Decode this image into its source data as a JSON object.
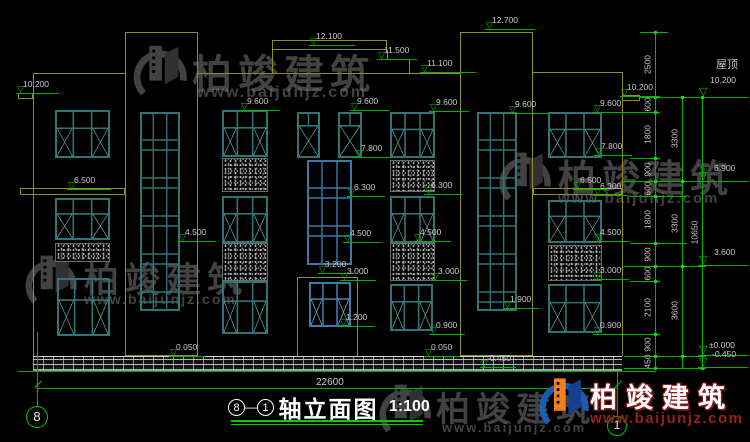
{
  "drawing": {
    "title": {
      "axis_from": "8",
      "axis_to": "1",
      "dash": "—",
      "name": "轴立面图",
      "scale": "1:100"
    },
    "axis_bubbles": {
      "left": "8",
      "right": "1"
    },
    "bottom_total": "22600",
    "roof_label": "屋顶",
    "watermark": {
      "brand": "柏竣建筑",
      "url": "www.baijunjz.com"
    },
    "colors": {
      "outline": "#8f8f28",
      "window_teal": "#2f7575",
      "window_teal_light": "#65a5a5",
      "window_blue": "#3c7aa8",
      "window_blue_light": "#7fb0d4",
      "dim_green": "#00b400",
      "label_text": "#c9c9c9",
      "wm_gray": "#787878",
      "wm_blue": "#1a5cae",
      "wm_orange": "#ee7f22",
      "wm_red": "#9b1f1f"
    },
    "elevation_markers": [
      {
        "t": "10.200",
        "x": 23,
        "y": 80,
        "lw": 42
      },
      {
        "t": "12.100",
        "x": 316,
        "y": 32,
        "lw": 46
      },
      {
        "t": "11.500",
        "x": 384,
        "y": 46,
        "lw": 40
      },
      {
        "t": "11.100",
        "x": 427,
        "y": 59,
        "lw": 56
      },
      {
        "t": "12.700",
        "x": 492,
        "y": 16,
        "lw": 50
      },
      {
        "t": "10.200",
        "x": 627,
        "y": 83,
        "lw": 40
      },
      {
        "t": "9.600",
        "x": 247,
        "y": 97,
        "lw": 40
      },
      {
        "t": "9.600",
        "x": 357,
        "y": 97,
        "lw": 40
      },
      {
        "t": "9.600",
        "x": 436,
        "y": 98,
        "lw": 40
      },
      {
        "t": "9.600",
        "x": 515,
        "y": 100,
        "lw": 40
      },
      {
        "t": "9.600",
        "x": 600,
        "y": 99,
        "lw": 40
      },
      {
        "t": "7.800",
        "x": 361,
        "y": 144,
        "lw": 38
      },
      {
        "t": "7.800",
        "x": 601,
        "y": 142,
        "lw": 38
      },
      {
        "t": "6.500",
        "x": 74,
        "y": 176,
        "lw": 44
      },
      {
        "t": "6.500",
        "x": 580,
        "y": 176,
        "lw": 34
      },
      {
        "t": "6.300",
        "x": 354,
        "y": 183,
        "lw": 38
      },
      {
        "t": "6.300",
        "x": 431,
        "y": 181,
        "lw": 38
      },
      {
        "t": "6.300",
        "x": 600,
        "y": 182,
        "lw": 34
      },
      {
        "t": "4.500",
        "x": 185,
        "y": 228,
        "lw": 38
      },
      {
        "t": "4.500",
        "x": 350,
        "y": 229,
        "lw": 38
      },
      {
        "t": "4.500",
        "x": 420,
        "y": 228,
        "lw": 38
      },
      {
        "t": "4.500",
        "x": 600,
        "y": 228,
        "lw": 36
      },
      {
        "t": "3.200",
        "x": 325,
        "y": 260,
        "lw": 36
      },
      {
        "t": "3.000",
        "x": 347,
        "y": 267,
        "lw": 36
      },
      {
        "t": "3.000",
        "x": 438,
        "y": 267,
        "lw": 36
      },
      {
        "t": "3.000",
        "x": 600,
        "y": 266,
        "lw": 36
      },
      {
        "t": "1.900",
        "x": 510,
        "y": 295,
        "lw": 36
      },
      {
        "t": "1.200",
        "x": 346,
        "y": 313,
        "lw": 36
      },
      {
        "t": "0.900",
        "x": 436,
        "y": 321,
        "lw": 36
      },
      {
        "t": "0.900",
        "x": 600,
        "y": 321,
        "lw": 36
      },
      {
        "t": "0.050",
        "x": 176,
        "y": 343,
        "lw": 36
      },
      {
        "t": "0.050",
        "x": 431,
        "y": 343,
        "lw": 36
      },
      {
        "t": "-0.450",
        "x": 487,
        "y": 354,
        "lw": 36
      }
    ],
    "right_markers": [
      {
        "t": "10.200",
        "x": 710,
        "y": 76,
        "ly": 97,
        "roof": true
      },
      {
        "t": "6.900",
        "x": 714,
        "y": 164,
        "ly": 181
      },
      {
        "t": "3.600",
        "x": 714,
        "y": 248,
        "ly": 265
      },
      {
        "t": "±0.000",
        "x": 709,
        "y": 341,
        "ly": 355
      },
      {
        "t": "-0.450",
        "x": 712,
        "y": 350,
        "ly": 367
      }
    ],
    "dim_chains": [
      {
        "x": 655,
        "top": 32,
        "bottom": 368,
        "segments": [
          {
            "from": 32,
            "to": 97,
            "label": "2500"
          },
          {
            "from": 97,
            "to": 112,
            "label": "600"
          },
          {
            "from": 112,
            "to": 158,
            "label": "1800"
          },
          {
            "from": 158,
            "to": 181,
            "label": "900"
          },
          {
            "from": 181,
            "to": 196,
            "label": "600"
          },
          {
            "from": 196,
            "to": 243,
            "label": "1800"
          },
          {
            "from": 243,
            "to": 266,
            "label": "900"
          },
          {
            "from": 266,
            "to": 281,
            "label": "600"
          },
          {
            "from": 281,
            "to": 334,
            "label": "2100"
          },
          {
            "from": 334,
            "to": 356,
            "label": "900"
          },
          {
            "from": 356,
            "to": 368,
            "label": "450"
          }
        ]
      },
      {
        "x": 682,
        "top": 97,
        "bottom": 368,
        "segments": [
          {
            "from": 97,
            "to": 181,
            "label": "3300"
          },
          {
            "from": 181,
            "to": 266,
            "label": "3300"
          },
          {
            "from": 266,
            "to": 356,
            "label": "3600"
          }
        ]
      },
      {
        "x": 702,
        "top": 97,
        "bottom": 368,
        "segments": [
          {
            "from": 97,
            "to": 368,
            "label": "10650"
          }
        ]
      }
    ],
    "ext_lines": [
      {
        "y": 32,
        "x1": 640,
        "x2": 668
      },
      {
        "y": 97,
        "x1": 640,
        "x2": 706
      },
      {
        "y": 112,
        "x1": 630,
        "x2": 660
      },
      {
        "y": 158,
        "x1": 630,
        "x2": 660
      },
      {
        "y": 181,
        "x1": 624,
        "x2": 706
      },
      {
        "y": 196,
        "x1": 630,
        "x2": 687
      },
      {
        "y": 243,
        "x1": 630,
        "x2": 687
      },
      {
        "y": 266,
        "x1": 624,
        "x2": 706
      },
      {
        "y": 281,
        "x1": 630,
        "x2": 660
      },
      {
        "y": 334,
        "x1": 630,
        "x2": 660
      },
      {
        "y": 356,
        "x1": 624,
        "x2": 706
      },
      {
        "y": 368,
        "x1": 624,
        "x2": 706
      }
    ],
    "facade": {
      "outline": [
        {
          "k": "h",
          "x": 33,
          "y": 73,
          "l": 92
        },
        {
          "k": "v",
          "x": 33,
          "y": 73,
          "l": 283
        },
        {
          "k": "r",
          "x": 18,
          "y": 93,
          "w": 15,
          "h": 6
        },
        {
          "k": "r",
          "x": 125,
          "y": 32,
          "w": 73,
          "h": 324
        },
        {
          "k": "h",
          "x": 198,
          "y": 73,
          "l": 262
        },
        {
          "k": "r",
          "x": 272,
          "y": 40,
          "w": 115,
          "h": 10
        },
        {
          "k": "v",
          "x": 272,
          "y": 50,
          "l": 23
        },
        {
          "k": "v",
          "x": 387,
          "y": 50,
          "l": 9
        },
        {
          "k": "h",
          "x": 387,
          "y": 59,
          "l": 22
        },
        {
          "k": "v",
          "x": 409,
          "y": 59,
          "l": 14
        },
        {
          "k": "r",
          "x": 460,
          "y": 32,
          "w": 73,
          "h": 324
        },
        {
          "k": "h",
          "x": 533,
          "y": 72,
          "l": 89
        },
        {
          "k": "v",
          "x": 622,
          "y": 72,
          "l": 284
        },
        {
          "k": "r",
          "x": 622,
          "y": 95,
          "w": 18,
          "h": 6
        },
        {
          "k": "r",
          "x": 20,
          "y": 188,
          "w": 105,
          "h": 7
        },
        {
          "k": "r",
          "x": 533,
          "y": 188,
          "w": 89,
          "h": 7
        },
        {
          "k": "r",
          "x": 297,
          "y": 277,
          "w": 61,
          "h": 83
        }
      ],
      "windows": [
        {
          "x": 55,
          "y": 110,
          "w": 55,
          "h": 48,
          "t": "a"
        },
        {
          "x": 55,
          "y": 198,
          "w": 55,
          "h": 42,
          "t": "a"
        },
        {
          "x": 57,
          "y": 278,
          "w": 53,
          "h": 58,
          "t": "a"
        },
        {
          "x": 140,
          "y": 112,
          "w": 40,
          "h": 199,
          "t": "strip"
        },
        {
          "x": 222,
          "y": 110,
          "w": 46,
          "h": 47,
          "t": "a"
        },
        {
          "x": 222,
          "y": 196,
          "w": 46,
          "h": 47,
          "t": "a"
        },
        {
          "x": 222,
          "y": 281,
          "w": 46,
          "h": 53,
          "t": "a"
        },
        {
          "x": 297,
          "y": 112,
          "w": 23,
          "h": 46,
          "t": "small"
        },
        {
          "x": 338,
          "y": 112,
          "w": 24,
          "h": 46,
          "t": "small"
        },
        {
          "x": 307,
          "y": 160,
          "w": 45,
          "h": 105,
          "t": "strip",
          "blue": true
        },
        {
          "x": 309,
          "y": 282,
          "w": 42,
          "h": 45,
          "t": "a",
          "blue": true
        },
        {
          "x": 390,
          "y": 112,
          "w": 45,
          "h": 46,
          "t": "a"
        },
        {
          "x": 390,
          "y": 196,
          "w": 45,
          "h": 47,
          "t": "a"
        },
        {
          "x": 390,
          "y": 284,
          "w": 43,
          "h": 47,
          "t": "a"
        },
        {
          "x": 477,
          "y": 112,
          "w": 40,
          "h": 199,
          "t": "strip"
        },
        {
          "x": 548,
          "y": 112,
          "w": 54,
          "h": 46,
          "t": "a"
        },
        {
          "x": 548,
          "y": 200,
          "w": 54,
          "h": 43,
          "t": "a"
        },
        {
          "x": 548,
          "y": 284,
          "w": 54,
          "h": 49,
          "t": "a"
        }
      ],
      "panels": [
        {
          "x": 55,
          "y": 243,
          "w": 55,
          "h": 19
        },
        {
          "x": 222,
          "y": 158,
          "w": 46,
          "h": 34
        },
        {
          "x": 222,
          "y": 243,
          "w": 46,
          "h": 38
        },
        {
          "x": 390,
          "y": 160,
          "w": 45,
          "h": 32
        },
        {
          "x": 390,
          "y": 243,
          "w": 45,
          "h": 38
        },
        {
          "x": 548,
          "y": 245,
          "w": 54,
          "h": 36
        }
      ],
      "plinth": {
        "x": 33,
        "y": 356,
        "w": 589,
        "h": 15
      },
      "green_lines": [
        {
          "k": "h",
          "x": 18,
          "y": 371,
          "l": 638
        },
        {
          "k": "h",
          "x": 37,
          "y": 388,
          "l": 580
        },
        {
          "k": "v",
          "x": 37,
          "y": 332,
          "l": 74
        },
        {
          "k": "v",
          "x": 617,
          "y": 372,
          "l": 44
        }
      ]
    },
    "watermarks": {
      "gray": [
        {
          "lx": 130,
          "ly": 38,
          "lw": 58,
          "lh": 62,
          "tx": 192,
          "ty": 42,
          "ts": 40,
          "ux": 197,
          "uy": 84,
          "us": 16
        },
        {
          "lx": 496,
          "ly": 146,
          "lw": 56,
          "lh": 58,
          "tx": 558,
          "ty": 148,
          "ts": 38,
          "ux": 558,
          "uy": 190,
          "us": 15
        },
        {
          "lx": 22,
          "ly": 248,
          "lw": 56,
          "lh": 60,
          "tx": 84,
          "ty": 252,
          "ts": 35,
          "ux": 84,
          "uy": 291,
          "us": 14
        },
        {
          "lx": 376,
          "ly": 378,
          "lw": 56,
          "lh": 58,
          "tx": 436,
          "ty": 382,
          "ts": 34,
          "ux": 442,
          "uy": 420,
          "us": 13
        }
      ],
      "colored": {
        "lx": 536,
        "ly": 372,
        "lw": 54,
        "lh": 56,
        "tx": 590,
        "ty": 376,
        "ux": 590,
        "uy": 410
      }
    }
  }
}
